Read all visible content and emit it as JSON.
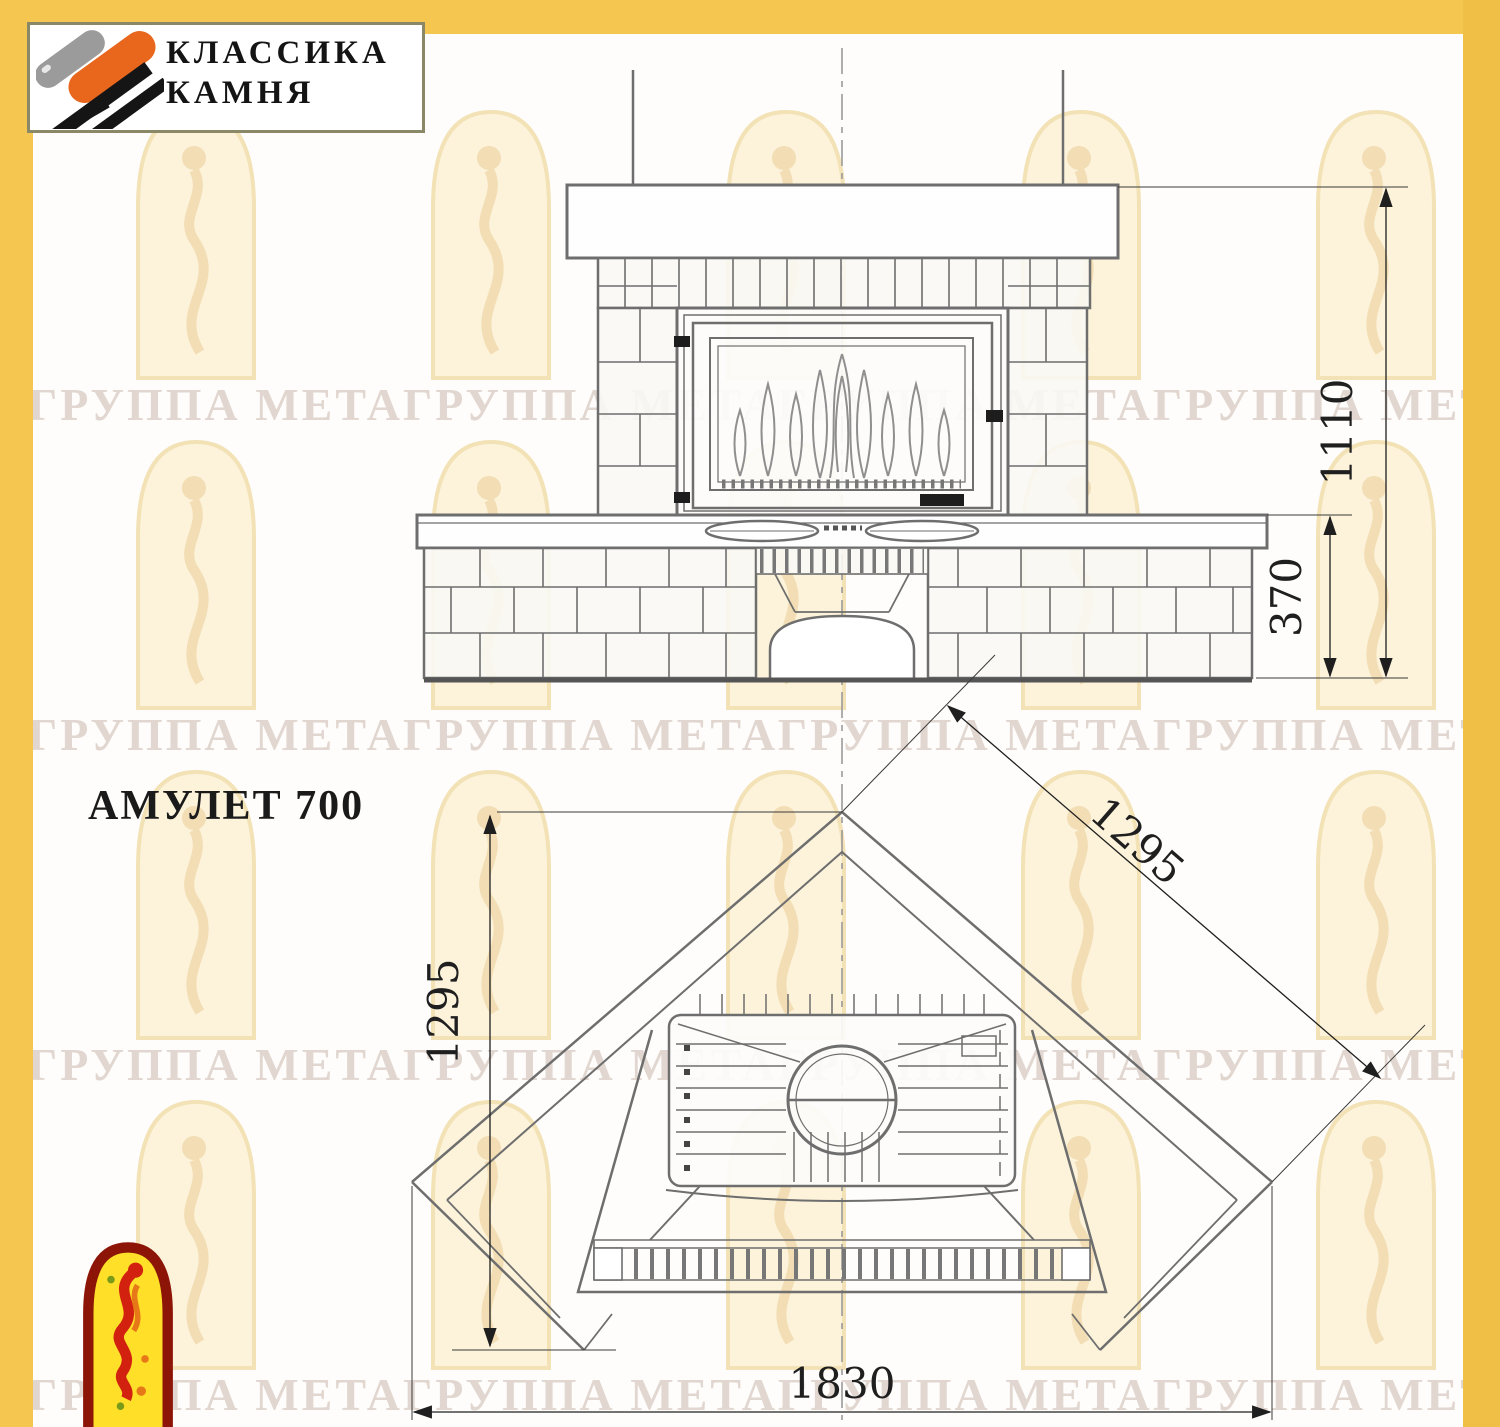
{
  "title": "АМУЛЕТ 700",
  "logo": {
    "line1": "КЛАССИКА",
    "line2": "КАМНЯ"
  },
  "watermark": {
    "text": "ГРУППА МЕТАГРУППА МЕТАГРУППА МЕТАГРУППА МЕТАГРУППА МЕТАГРУППА МЕТА"
  },
  "front_view": {
    "label": "front-elevation-of-fireplace",
    "height_mm": "1110",
    "base_height_mm": "370"
  },
  "plan_view": {
    "label": "corner-installation-plan",
    "depth_mm": "1295",
    "wall_length_mm": "1295",
    "width_mm": "1830"
  },
  "icons": {
    "header": "stone-logo-icon",
    "footer": "jester-arch-icon",
    "background": "watermark-arch-icon"
  },
  "colors": {
    "frame_yellow": "#f5c751",
    "drawing_gray": "#6e6e6e",
    "dimension_ink": "#1f1f1f",
    "logo_orange": "#e8671c",
    "footer_red": "#8c1507",
    "footer_yellow": "#ffdf28"
  }
}
